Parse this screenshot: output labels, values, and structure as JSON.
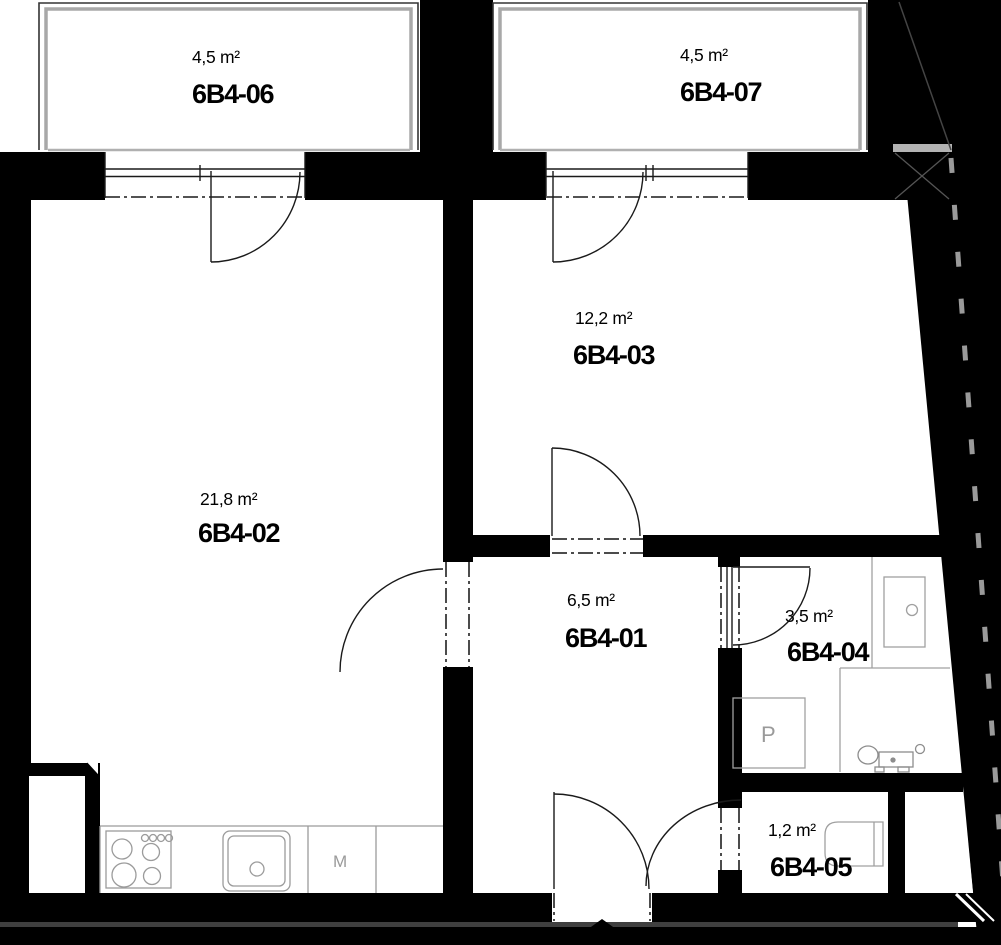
{
  "floorplan": {
    "unit_prefix": "6B4",
    "rooms": [
      {
        "id": "6B4-06",
        "area": "4,5 m²"
      },
      {
        "id": "6B4-07",
        "area": "4,5 m²"
      },
      {
        "id": "6B4-02",
        "area": "21,8 m²"
      },
      {
        "id": "6B4-03",
        "area": "12,2 m²"
      },
      {
        "id": "6B4-01",
        "area": "6,5 m²"
      },
      {
        "id": "6B4-04",
        "area": "3,5 m²"
      },
      {
        "id": "6B4-05",
        "area": "1,2 m²"
      }
    ],
    "appliances": {
      "kitchen_unit_label": "M",
      "bathroom_unit_label": "P"
    },
    "colors": {
      "wall": "#000000",
      "fixture_outline": "#999999",
      "boundary_dash": "#9a9a9a"
    }
  }
}
